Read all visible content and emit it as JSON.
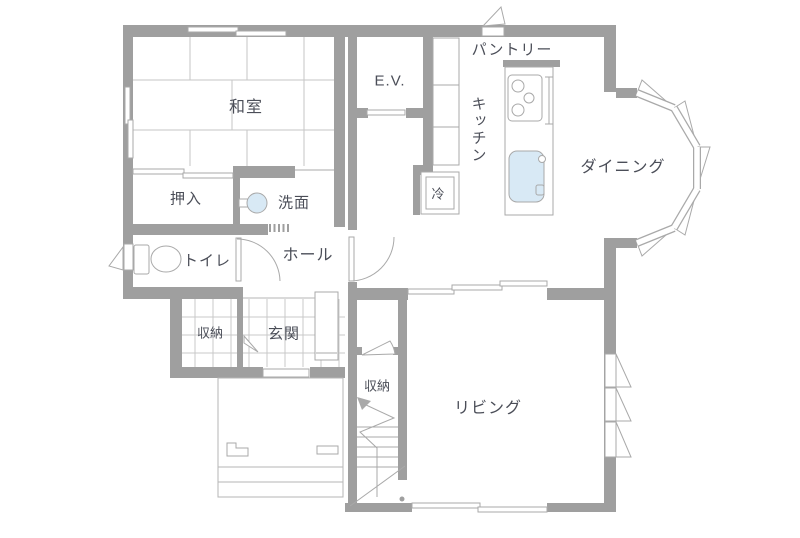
{
  "title": "floor-plan-1f",
  "colors": {
    "wall": "#9f9f9f",
    "line": "#a9a9a9",
    "grid": "#c9c9c9",
    "water": "#d8e9f5",
    "text": "#4b4e58"
  },
  "rooms": {
    "washitsu": "和室",
    "oshiire": "押入",
    "senmen": "洗面",
    "toilet": "トイレ",
    "hall": "ホール",
    "genkan_storage": "収納",
    "genkan": "玄関",
    "stair_storage": "収納",
    "elevator": "E.V.",
    "pantry": "パントリー",
    "kitchen": "キッチン",
    "fridge": "冷",
    "dining": "ダイニング",
    "living": "リビング"
  }
}
